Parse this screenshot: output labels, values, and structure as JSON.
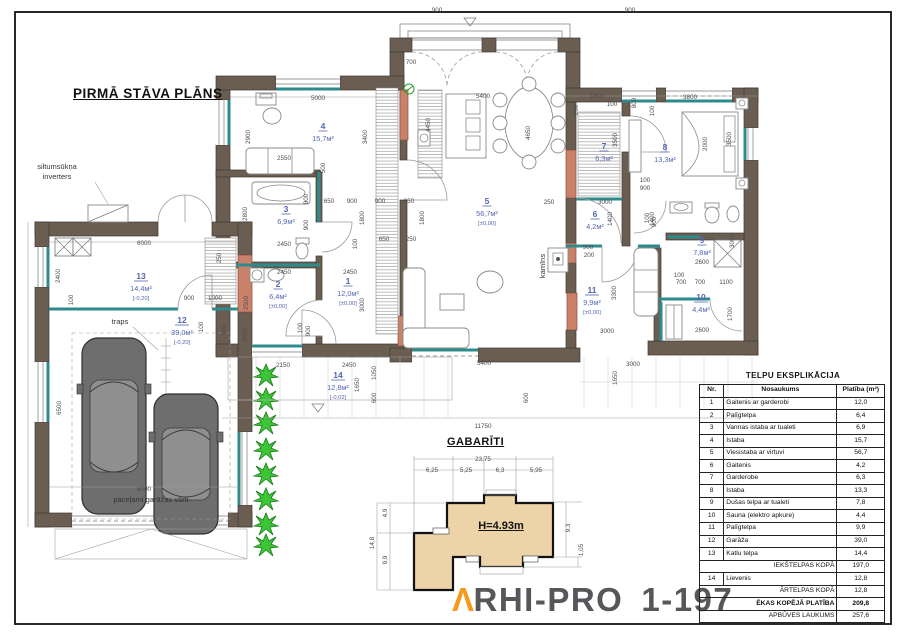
{
  "titles": {
    "plan_title": "PIRMĀ STĀVA PLĀNS",
    "gabariti_title": "GABARĪTI",
    "height_label": "H=4.93m"
  },
  "logo": {
    "a": "Λ",
    "rest": "RHI-PRO",
    "number": "1-197",
    "orange": "#f49a1c",
    "gray": "#56575a"
  },
  "colors": {
    "wall": "#6a5d52",
    "partition_teal": "#2e8b8b",
    "column_salmon": "#c9816a",
    "gabariti_beige": "#ecd3a8",
    "room_label_blue": "#5565b2",
    "bush_green": "#3ec437"
  },
  "plan": {
    "rooms": [
      {
        "nr": "1",
        "area": "12,0м²",
        "elev": "[±0,00]",
        "x": 348,
        "y": 284
      },
      {
        "nr": "2",
        "area": "6,4м²",
        "elev": "[±0,00]",
        "x": 278,
        "y": 287
      },
      {
        "nr": "3",
        "area": "6,9м²",
        "elev": "",
        "x": 286,
        "y": 212
      },
      {
        "nr": "4",
        "area": "15,7м²",
        "elev": "",
        "x": 323,
        "y": 129
      },
      {
        "nr": "5",
        "area": "56,7м²",
        "elev": "[±0,00]",
        "x": 487,
        "y": 204
      },
      {
        "nr": "6",
        "area": "4,2м²",
        "elev": "",
        "x": 595,
        "y": 217
      },
      {
        "nr": "7",
        "area": "6,3м²",
        "elev": "",
        "x": 604,
        "y": 149
      },
      {
        "nr": "8",
        "area": "13,3м²",
        "elev": "",
        "x": 665,
        "y": 150
      },
      {
        "nr": "9",
        "area": "7,8м²",
        "elev": "",
        "x": 702,
        "y": 243
      },
      {
        "nr": "10",
        "area": "4,4м²",
        "elev": "",
        "x": 701,
        "y": 300
      },
      {
        "nr": "11",
        "area": "9,9м²",
        "elev": "[±0,00]",
        "x": 592,
        "y": 293
      },
      {
        "nr": "12",
        "area": "39,0м²",
        "elev": "[-0,20]",
        "x": 182,
        "y": 323
      },
      {
        "nr": "13",
        "area": "14,4м²",
        "elev": "[-0,20]",
        "x": 141,
        "y": 279
      },
      {
        "nr": "14",
        "area": "12,8м²",
        "elev": "[-0,02]",
        "x": 338,
        "y": 378
      }
    ],
    "labels": [
      {
        "t": "siltumsūkņa",
        "x": 57,
        "y": 169,
        "a": "start"
      },
      {
        "t": "inverters",
        "x": 57,
        "y": 179,
        "a": "start"
      },
      {
        "t": "traps",
        "x": 120,
        "y": 324
      },
      {
        "t": "kamīns",
        "x": 545,
        "y": 266,
        "r": 1
      },
      {
        "t": "paceļami garāžas vārti",
        "x": 151,
        "y": 502
      }
    ],
    "dims": [
      {
        "t": "900",
        "x": 437,
        "y": 12
      },
      {
        "t": "900",
        "x": 630,
        "y": 12
      },
      {
        "t": "700",
        "x": 411,
        "y": 64
      },
      {
        "t": "5000",
        "x": 318,
        "y": 100
      },
      {
        "t": "1800",
        "x": 597,
        "y": 98
      },
      {
        "t": "100",
        "x": 612,
        "y": 106
      },
      {
        "t": "3800",
        "x": 690,
        "y": 99
      },
      {
        "t": "250",
        "x": 578,
        "y": 110,
        "r": 1
      },
      {
        "t": "2900",
        "x": 250,
        "y": 137,
        "r": 1
      },
      {
        "t": "2550",
        "x": 284,
        "y": 160
      },
      {
        "t": "3400",
        "x": 367,
        "y": 137,
        "r": 1
      },
      {
        "t": "4450",
        "x": 430,
        "y": 125,
        "r": 1
      },
      {
        "t": "5400",
        "x": 483,
        "y": 98
      },
      {
        "t": "4650",
        "x": 530,
        "y": 133,
        "r": 1
      },
      {
        "t": "800",
        "x": 636,
        "y": 103,
        "r": 1
      },
      {
        "t": "100",
        "x": 654,
        "y": 111,
        "r": 1
      },
      {
        "t": "3500",
        "x": 617,
        "y": 140,
        "r": 1
      },
      {
        "t": "2000",
        "x": 707,
        "y": 144,
        "r": 1
      },
      {
        "t": "3500",
        "x": 731,
        "y": 139,
        "r": 1
      },
      {
        "t": "500",
        "x": 325,
        "y": 168,
        "r": 1
      },
      {
        "t": "650",
        "x": 329,
        "y": 203
      },
      {
        "t": "900",
        "x": 352,
        "y": 203
      },
      {
        "t": "900",
        "x": 380,
        "y": 203
      },
      {
        "t": "650",
        "x": 409,
        "y": 203
      },
      {
        "t": "900",
        "x": 308,
        "y": 199,
        "r": 1
      },
      {
        "t": "900",
        "x": 308,
        "y": 225,
        "r": 1
      },
      {
        "t": "1800",
        "x": 364,
        "y": 218,
        "r": 1
      },
      {
        "t": "1800",
        "x": 424,
        "y": 218,
        "r": 1
      },
      {
        "t": "2800",
        "x": 247,
        "y": 214,
        "r": 1
      },
      {
        "t": "2450",
        "x": 284,
        "y": 246
      },
      {
        "t": "100",
        "x": 357,
        "y": 244,
        "r": 1
      },
      {
        "t": "650",
        "x": 384,
        "y": 241
      },
      {
        "t": "250",
        "x": 411,
        "y": 241
      },
      {
        "t": "2450",
        "x": 284,
        "y": 274
      },
      {
        "t": "2450",
        "x": 350,
        "y": 274
      },
      {
        "t": "2500",
        "x": 248,
        "y": 303,
        "r": 1
      },
      {
        "t": "3000",
        "x": 364,
        "y": 305,
        "r": 1
      },
      {
        "t": "100",
        "x": 302,
        "y": 328,
        "r": 1
      },
      {
        "t": "900",
        "x": 310,
        "y": 331,
        "r": 1
      },
      {
        "t": "100",
        "x": 645,
        "y": 182
      },
      {
        "t": "900",
        "x": 645,
        "y": 190
      },
      {
        "t": "250",
        "x": 549,
        "y": 204
      },
      {
        "t": "3000",
        "x": 605,
        "y": 204
      },
      {
        "t": "1400",
        "x": 612,
        "y": 219,
        "r": 1
      },
      {
        "t": "1400",
        "x": 654,
        "y": 219,
        "r": 1
      },
      {
        "t": "900",
        "x": 588,
        "y": 249
      },
      {
        "t": "200",
        "x": 589,
        "y": 257
      },
      {
        "t": "100",
        "x": 649,
        "y": 218,
        "r": 1
      },
      {
        "t": "900",
        "x": 656,
        "y": 222,
        "r": 1
      },
      {
        "t": "100",
        "x": 679,
        "y": 277
      },
      {
        "t": "700",
        "x": 681,
        "y": 284
      },
      {
        "t": "700",
        "x": 700,
        "y": 284
      },
      {
        "t": "1100",
        "x": 726,
        "y": 284
      },
      {
        "t": "3000",
        "x": 734,
        "y": 241,
        "r": 1
      },
      {
        "t": "1700",
        "x": 732,
        "y": 314,
        "r": 1
      },
      {
        "t": "2600",
        "x": 702,
        "y": 264
      },
      {
        "t": "2600",
        "x": 702,
        "y": 332
      },
      {
        "t": "3300",
        "x": 616,
        "y": 293,
        "r": 1
      },
      {
        "t": "3000",
        "x": 607,
        "y": 333
      },
      {
        "t": "3000",
        "x": 633,
        "y": 366
      },
      {
        "t": "1650",
        "x": 617,
        "y": 378,
        "r": 1
      },
      {
        "t": "2150",
        "x": 283,
        "y": 367
      },
      {
        "t": "2450",
        "x": 349,
        "y": 367
      },
      {
        "t": "1650",
        "x": 359,
        "y": 385,
        "r": 1
      },
      {
        "t": "1050",
        "x": 376,
        "y": 373,
        "r": 1
      },
      {
        "t": "600",
        "x": 376,
        "y": 398,
        "r": 1
      },
      {
        "t": "5400",
        "x": 484,
        "y": 365
      },
      {
        "t": "600",
        "x": 528,
        "y": 398,
        "r": 1
      },
      {
        "t": "11750",
        "x": 483,
        "y": 428
      },
      {
        "t": "6000",
        "x": 144,
        "y": 245
      },
      {
        "t": "250",
        "x": 221,
        "y": 258,
        "r": 1
      },
      {
        "t": "2400",
        "x": 60,
        "y": 276,
        "r": 1
      },
      {
        "t": "100",
        "x": 73,
        "y": 300,
        "r": 1
      },
      {
        "t": "2500",
        "x": 247,
        "y": 335,
        "r": 1
      },
      {
        "t": "900",
        "x": 189,
        "y": 300
      },
      {
        "t": "1000",
        "x": 215,
        "y": 300
      },
      {
        "t": "100",
        "x": 203,
        "y": 327,
        "r": 1
      },
      {
        "t": "900",
        "x": 226,
        "y": 330,
        "r": 1
      },
      {
        "t": "6500",
        "x": 61,
        "y": 408,
        "r": 1
      },
      {
        "t": "6000",
        "x": 144,
        "y": 491
      }
    ]
  },
  "gabariti": {
    "title": "GABARĪTI",
    "height": "H=4.93m",
    "total": "23,75",
    "segments": [
      "6,25",
      "5,25",
      "6,3",
      "5,95"
    ],
    "dims": [
      {
        "t": "23,75",
        "x": 483,
        "y": 461
      },
      {
        "t": "6,25",
        "x": 432,
        "y": 472
      },
      {
        "t": "5,25",
        "x": 466,
        "y": 472
      },
      {
        "t": "6,3",
        "x": 500,
        "y": 472
      },
      {
        "t": "5,95",
        "x": 536,
        "y": 472
      },
      {
        "t": "9,3",
        "x": 570,
        "y": 528,
        "r": 1
      },
      {
        "t": "1,05",
        "x": 583,
        "y": 550,
        "r": 1
      },
      {
        "t": "4,9",
        "x": 387,
        "y": 513,
        "r": 1
      },
      {
        "t": "14,8",
        "x": 374,
        "y": 543,
        "r": 1
      },
      {
        "t": "9,9",
        "x": 387,
        "y": 560,
        "r": 1
      }
    ]
  },
  "table": {
    "title": "TELPU EKSPLIKĀCIJA",
    "headers": [
      "Nr.",
      "Nosaukums",
      "Platība (m²)"
    ],
    "rows": [
      {
        "nr": "1",
        "name": "Gaitenis ar garderobi",
        "val": "12,0"
      },
      {
        "nr": "2",
        "name": "Palīgtelpa",
        "val": "6,4"
      },
      {
        "nr": "3",
        "name": "Vannas istaba ar tualeti",
        "val": "6,9"
      },
      {
        "nr": "4",
        "name": "Istaba",
        "val": "15,7"
      },
      {
        "nr": "5",
        "name": "Viesistaba ar virtuvi",
        "val": "56,7"
      },
      {
        "nr": "6",
        "name": "Gaitenis",
        "val": "4,2"
      },
      {
        "nr": "7",
        "name": "Garderobe",
        "val": "6,3"
      },
      {
        "nr": "8",
        "name": "Istaba",
        "val": "13,3"
      },
      {
        "nr": "9",
        "name": "Dušas telpa ar tualeti",
        "val": "7,8"
      },
      {
        "nr": "10",
        "name": "Sauna (elektro apkure)",
        "val": "4,4"
      },
      {
        "nr": "11",
        "name": "Palīgtelpa",
        "val": "9,9"
      },
      {
        "nr": "12",
        "name": "Garāža",
        "val": "39,0"
      },
      {
        "nr": "13",
        "name": "Katlu telpa",
        "val": "14,4"
      },
      {
        "nr": "",
        "name": "IEKŠTELPAS KOPĀ",
        "val": "197,0",
        "sum": true
      },
      {
        "nr": "14",
        "name": "Lievenis",
        "val": "12,8"
      },
      {
        "nr": "",
        "name": "ĀRTELPAS KOPĀ",
        "val": "12,8",
        "sum": true
      },
      {
        "nr": "",
        "name": "ĒKAS KOPĒJĀ PLATĪBA",
        "val": "209,8",
        "sum": true,
        "bold": true
      },
      {
        "nr": "",
        "name": "APBŪVES LAUKUMS",
        "val": "257,6",
        "sum": true
      }
    ]
  }
}
